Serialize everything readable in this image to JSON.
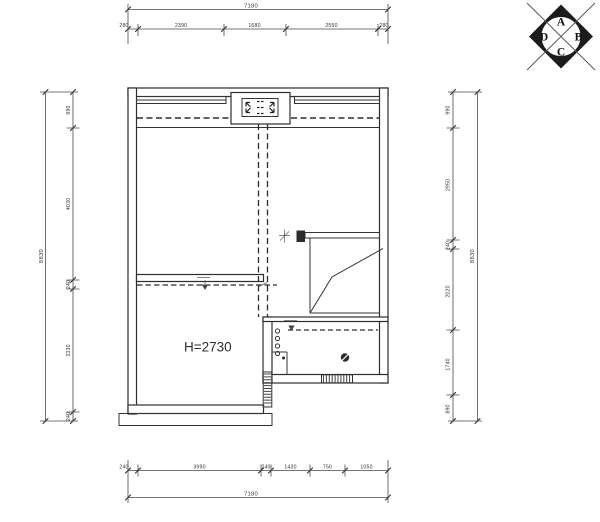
{
  "room": {
    "height_label": "H=2730"
  },
  "compass": {
    "top": "A",
    "right": "B",
    "bottom": "C",
    "left": "D"
  },
  "dims": {
    "top": {
      "total": "7180",
      "segments": [
        "280",
        "2390",
        "1680",
        "2550",
        "280"
      ]
    },
    "bottom": {
      "total": "7180",
      "segments": [
        "240",
        "3990",
        "240",
        "1430",
        "750",
        "1050"
      ]
    },
    "left": {
      "total": "8830",
      "segments": [
        "990",
        "4030",
        "240",
        "3330",
        "240"
      ]
    },
    "right": {
      "total": "8830",
      "segments": [
        "990",
        "2950",
        "240",
        "2020",
        "1740",
        "890"
      ]
    }
  }
}
